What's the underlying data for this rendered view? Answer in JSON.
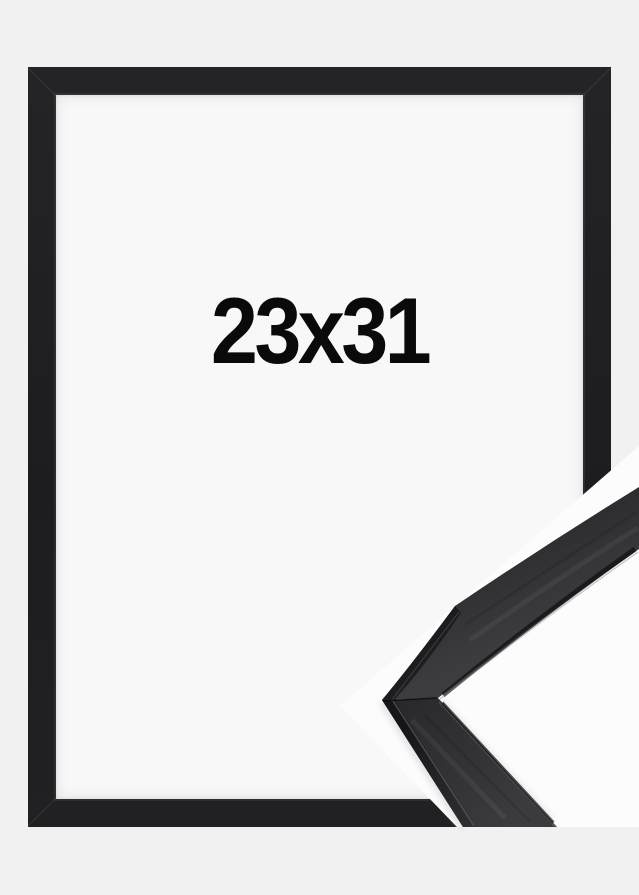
{
  "frame_preview": {
    "size_label": "23x31",
    "frame_color": "#1f1f21",
    "interior_color": "#f8f8f9",
    "background_color": "#f1f1f2"
  },
  "corner_detail": {
    "halo_color": "#fcfcfd",
    "moulding_face_color": "#353538",
    "moulding_side_color": "#1d1d1f",
    "edge_highlight_color": "#94949a",
    "inner_shadow_line_color": "#131315"
  }
}
